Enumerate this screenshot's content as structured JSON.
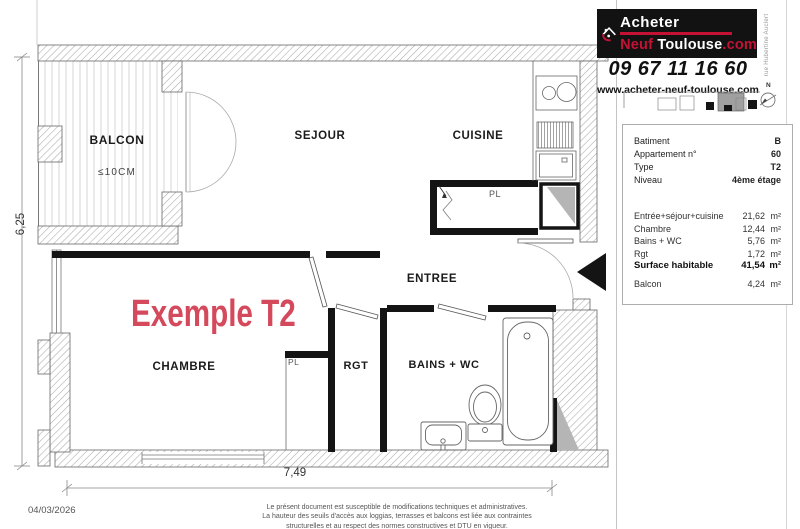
{
  "colors": {
    "brand_red": "#c41235",
    "example_red": "#d4495c",
    "wall_black": "#141414",
    "hatch_gray": "#a8a8a8",
    "duct_gray": "#b5b5b5"
  },
  "branding": {
    "logo_line1": "Acheter",
    "logo_line2_part1": "Neuf",
    "logo_line2_part2": " Toulouse",
    "logo_line2_part3": ".com",
    "phone": "09 67 11 16 60",
    "website": "www.acheter-neuf-toulouse.com",
    "street_label": "rue Hubertine Auclert",
    "compass_label": "N"
  },
  "info_panel": {
    "rows": [
      {
        "label": "Batiment",
        "value": "B"
      },
      {
        "label": "Appartement n°",
        "value": "60"
      },
      {
        "label": "Type",
        "value": "T2"
      },
      {
        "label": "Niveau",
        "value": "4ème étage"
      }
    ],
    "areas": [
      {
        "label": "Entrée+séjour+cuisine",
        "value": "21,62",
        "unit": "m²"
      },
      {
        "label": "Chambre",
        "value": "12,44",
        "unit": "m²"
      },
      {
        "label": "Bains + WC",
        "value": "5,76",
        "unit": "m²"
      },
      {
        "label": "Rgt",
        "value": "1,72",
        "unit": "m²"
      },
      {
        "label": "Surface habitable",
        "value": "41,54",
        "unit": "m²"
      },
      {
        "label": "Balcon",
        "value": "4,24",
        "unit": "m²"
      }
    ]
  },
  "plan": {
    "watermark": "Exemple T2",
    "rooms": {
      "balcon": "BALCON",
      "balcon_note": "≤10CM",
      "sejour": "SEJOUR",
      "cuisine": "CUISINE",
      "entree": "ENTREE",
      "chambre": "CHAMBRE",
      "rgt": "RGT",
      "bains": "BAINS + WC",
      "placard_kitchen": "PL",
      "placard_chambre": "PL"
    },
    "dimensions": {
      "bottom": "7,49",
      "left": "6,25"
    }
  },
  "footer": {
    "date": "04/03/2026",
    "disclaimer": [
      "Le présent document est susceptible de modifications techniques et administratives.",
      "La hauteur des seuils d'accès aux loggias, terrasses et balcons est liée aux contraintes",
      "structurelles et au respect des normes constructives et DTU en vigueur."
    ]
  }
}
